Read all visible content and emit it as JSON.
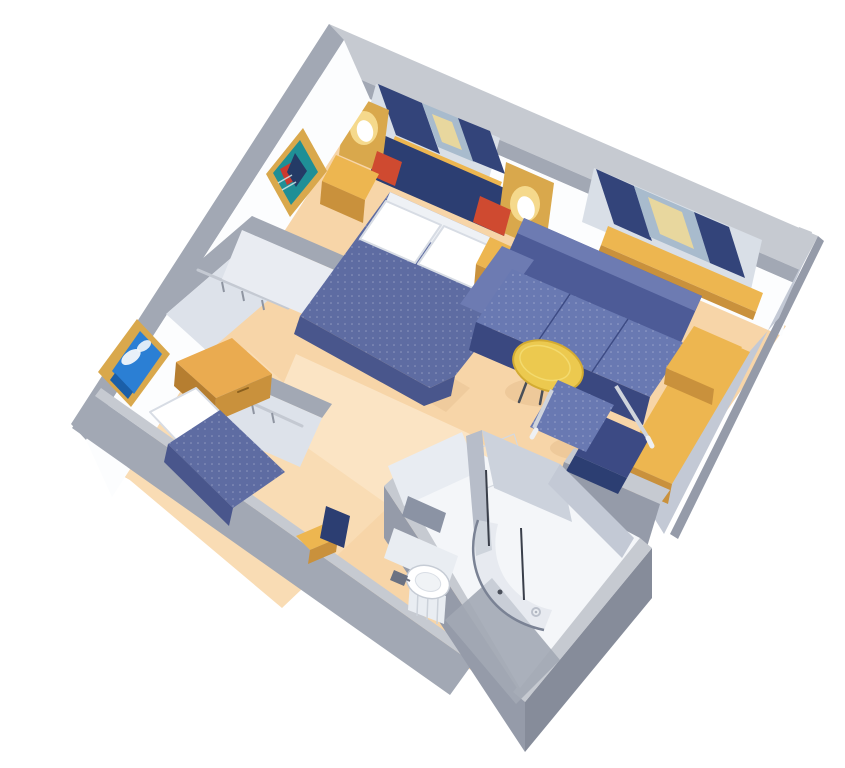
{
  "scene": {
    "type": "isometric-cutaway-floorplan",
    "subject": "cruise-ship-stateroom-3d-rendering",
    "rooms": [
      {
        "name": "main-stateroom",
        "items": [
          "queen-bed",
          "headboard",
          "pillows",
          "red-accent-cushions",
          "wall-sconce-left",
          "wall-sconce-right",
          "nightstand-left",
          "nightstand-right",
          "window-with-curtains-1",
          "window-with-curtains-2",
          "sofa",
          "end-table",
          "coffee-table",
          "armchair",
          "desk",
          "framed-picture-abstract"
        ]
      },
      {
        "name": "second-room",
        "items": [
          "single-bed",
          "wood-cabinet",
          "framed-picture-seascape",
          "closet-upper",
          "closet-lower"
        ]
      },
      {
        "name": "bathroom",
        "items": [
          "mirror",
          "vanity-sink",
          "faucet",
          "shower-enclosure",
          "shower-drain",
          "open-door"
        ]
      },
      {
        "name": "corridor",
        "items": [
          "stool",
          "bin"
        ]
      }
    ]
  },
  "palette": {
    "bg": "#ffffff",
    "floor_carpet": "#f7d5a8",
    "floor_left": "#f9dcb4",
    "floor_light": "#fbe4c4",
    "floor_shadow": "#eac394",
    "wall_top_light": "#c6cad1",
    "wall_band_gray": "#a2a8b4",
    "wall_band_dark": "#959ba9",
    "wall_band_darker": "#868c9a",
    "wall_face_white": "#fcfdfe",
    "wall_face_shadow": "#e8ecf2",
    "right_wall_gray": "#c3c9d5",
    "partition_light": "#dde2ea",
    "partition_lighter": "#e9ecf2",
    "recess_gray": "#d9dfe7",
    "curtain_navy": "#33447a",
    "window_glass": "#a8bbcd",
    "window_glow": "#e8d79e",
    "gold": "#edb650",
    "gold_dark": "#c9913c",
    "gold_deep": "#b67e30",
    "wood_cabinet": "#eaab50",
    "sconce_gold": "#d9a84c",
    "glow_warm": "#f5d98c",
    "headboard_navy": "#2c3e72",
    "spread_blue": "#5e6ca2",
    "spread_dark": "#49568c",
    "sheet_white": "#eef1f5",
    "pillow_white": "#ffffff",
    "red_accent": "#cf4a30",
    "sofa_back": "#4d5b97",
    "sofa_top": "#6d7bb2",
    "sofa_cushion": "#6979b2",
    "sofa_front": "#3a4880",
    "chair_back": "#3c4a84",
    "table_wood": "#ecc94f",
    "table_rim": "#d3ab32",
    "chrome": "#cfd4dc",
    "white_fixture": "#f4f6f9",
    "fixture_shade": "#e9edf2",
    "mirror_gray": "#8b93a4",
    "divider_gray": "#b7bdc9",
    "shower_wall": "#ccd2dc",
    "glass_tint": "#dde3ea",
    "line_dark": "#6b7282",
    "art_teal": "#1f8f96",
    "art_red": "#cc3a2e",
    "art_navy": "#243b66",
    "sea_blue": "#2b7fd4",
    "sea_deep": "#1b5fa8",
    "cloud_white": "#f2f7fb"
  }
}
